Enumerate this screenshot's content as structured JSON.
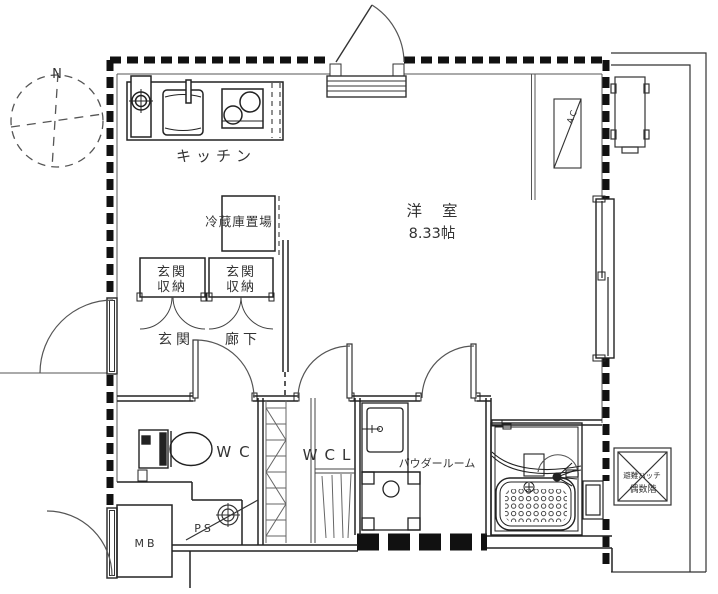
{
  "compass": {
    "north_label": "N"
  },
  "rooms": {
    "kitchen": {
      "label": "キッチン"
    },
    "refrigerator_space": {
      "label": "冷蔵庫置場"
    },
    "entrance_storage_left": {
      "line1": "玄関",
      "line2": "収納"
    },
    "entrance_storage_right": {
      "line1": "玄関",
      "line2": "収納"
    },
    "entrance": {
      "label": "玄関"
    },
    "hallway": {
      "label": "廊下"
    },
    "western_room": {
      "label": "洋室",
      "size": "8.33帖"
    },
    "toilet": {
      "label": "WC"
    },
    "walk_in_closet": {
      "label": "WCL"
    },
    "powder_room": {
      "label": "パウダールーム"
    },
    "meter_box": {
      "label": "MB"
    },
    "pipe_shaft": {
      "label": "PS"
    }
  },
  "fixtures": {
    "air_conditioner": {
      "label": "AC"
    },
    "evacuation_hatch": {
      "line1": "避難ハッチ",
      "line2": "偶数階"
    }
  },
  "colors": {
    "line": "#1a1a1a",
    "text": "#333333",
    "background": "#ffffff"
  }
}
